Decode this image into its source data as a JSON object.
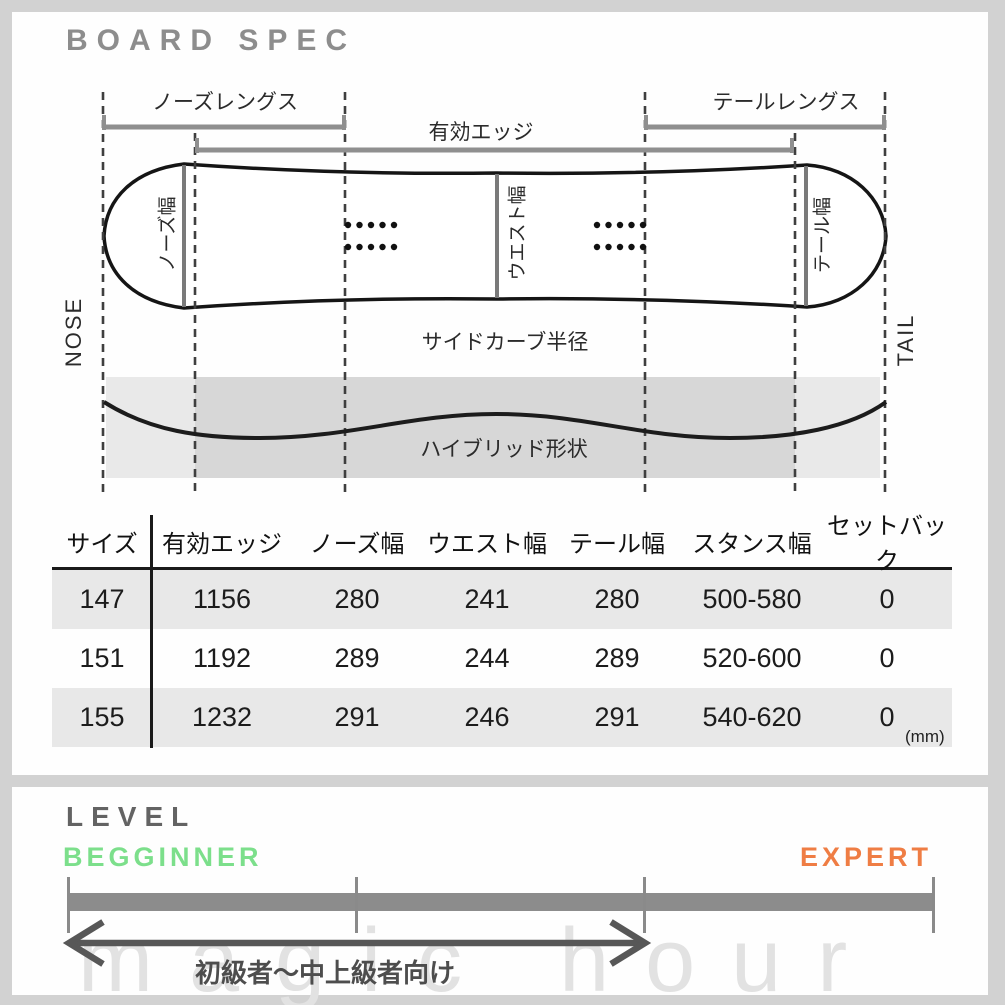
{
  "header": {
    "title": "BOARD SPEC"
  },
  "diagram": {
    "labels": {
      "nose_length": "ノーズレングス",
      "effective_edge": "有効エッジ",
      "tail_length": "テールレングス",
      "nose_width": "ノーズ幅",
      "waist_width": "ウエスト幅",
      "tail_width": "テール幅",
      "sidecut_radius": "サイドカーブ半径",
      "hybrid_shape": "ハイブリッド形状",
      "nose_end": "NOSE",
      "tail_end": "TAIL"
    }
  },
  "spec_table": {
    "unit": "(mm)",
    "columns": [
      "サイズ",
      "有効エッジ",
      "ノーズ幅",
      "ウエスト幅",
      "テール幅",
      "スタンス幅",
      "セットバック"
    ],
    "rows": [
      {
        "cells": [
          "147",
          "1156",
          "280",
          "241",
          "280",
          "500-580",
          "0"
        ]
      },
      {
        "cells": [
          "151",
          "1192",
          "289",
          "244",
          "289",
          "520-600",
          "0"
        ]
      },
      {
        "cells": [
          "155",
          "1232",
          "291",
          "246",
          "291",
          "540-620",
          "0"
        ]
      }
    ]
  },
  "level": {
    "title": "LEVEL",
    "beginner": "BEGGINNER",
    "expert": "EXPERT",
    "range_label": "初級者〜中上級者向け",
    "colors": {
      "beginner": "#7cdf8b",
      "expert": "#ef7d44"
    }
  },
  "watermark": "magic hour"
}
